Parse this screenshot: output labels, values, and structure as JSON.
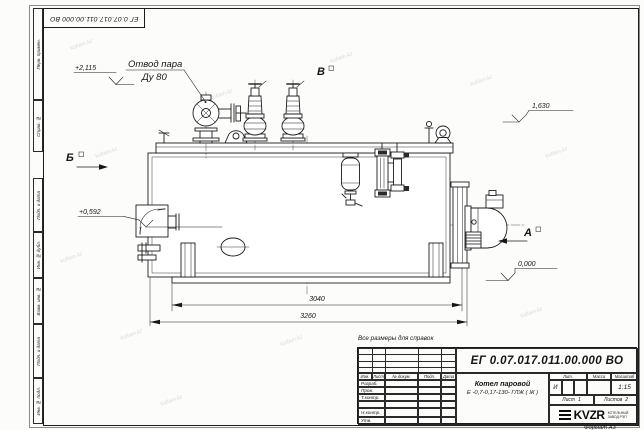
{
  "sheet": {
    "corner_doc_number": "ЕГ 0.07.017.011.00.000  ВО",
    "dimensions_note": "Все размеры для справок",
    "format_note": "Формат А3"
  },
  "margin": {
    "top": [
      "Перв. примен.",
      "Справ. №"
    ],
    "bottom": [
      "Подп. и дата",
      "Инв. № дубл.",
      "Взам. инв. №",
      "Подп. и дата",
      "Инв. № подл."
    ]
  },
  "title_block": {
    "doc_number": "ЕГ 0.07.017.011.00.000  ВО",
    "product_name": "Котел паровой",
    "product_type": "Е -0,7-0,17-130- ГЛЖ ( Ж )",
    "header": {
      "izm": "Изм.",
      "list": "Лист",
      "doc": "№ докум.",
      "podp": "Подп.",
      "data": "Дата"
    },
    "roles": [
      "Разраб.",
      "Пров.",
      "Т.контр.",
      "Н.контр.",
      "Утв."
    ],
    "lit_label": "Лит.",
    "lit_value": "И",
    "mass_label": "Масса",
    "scale_label": "Масштаб",
    "scale_value": "1:15",
    "sheet_label": "Лист",
    "sheet_value": "1",
    "sheets_label": "Листов",
    "sheets_value": "2",
    "logo": "KVZR",
    "logo_caption_1": "КОТЕЛЬНЫЙ",
    "logo_caption_2": "ЗАВОД РЭП"
  },
  "drawing": {
    "steam_outlet_label_1": "Отвод пара",
    "steam_outlet_label_2": "Ду 80",
    "view_a": "А",
    "view_b": "Б",
    "view_v": "В",
    "elev_top": "+2,115",
    "elev_mid": "1,630",
    "elev_burner": "+0,592",
    "elev_zero": "0,000",
    "dim_inner": "3040",
    "dim_overall": "3260"
  },
  "watermark": {
    "text": "kotlam.kz"
  }
}
